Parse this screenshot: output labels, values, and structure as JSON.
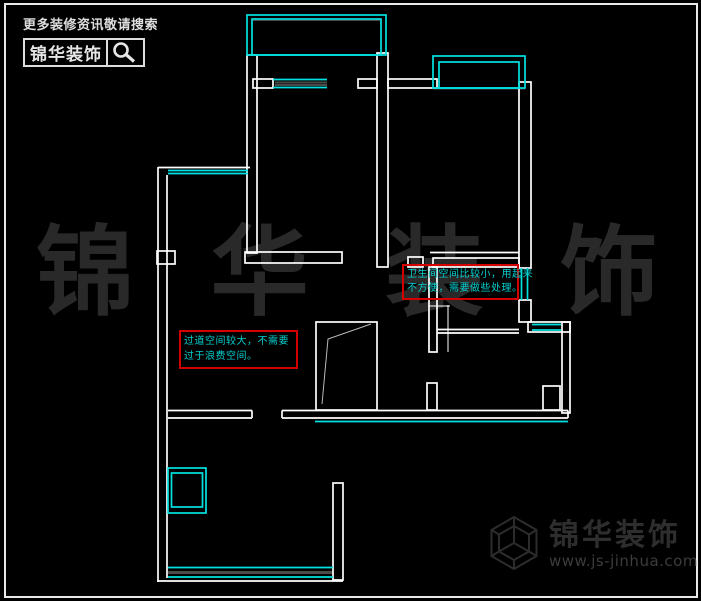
{
  "header": {
    "search_hint": "更多装修资讯敬请搜索",
    "brand": "锦华装饰"
  },
  "watermark": {
    "chars": [
      "锦",
      "华",
      "装",
      "饰"
    ]
  },
  "annotations": {
    "bathroom": {
      "line1": "卫生间空间比较小，用起来",
      "line2": "不方便，需要做些处理。"
    },
    "hallway": {
      "line1": "过道空间较大，不需要",
      "line2": "过于浪费空间。"
    }
  },
  "footer": {
    "brand": "锦华装饰",
    "url": "www.js-jinhua.com"
  },
  "colors": {
    "background": "#000000",
    "wall_line": "#ffffff",
    "window_line": "#00e1e1",
    "annotation_border": "#d40000",
    "annotation_text": "#00cfcf",
    "watermark_gray": "#292929",
    "footer_gray": "#2e2e2e",
    "sill_gray": "#4a4a4a"
  }
}
